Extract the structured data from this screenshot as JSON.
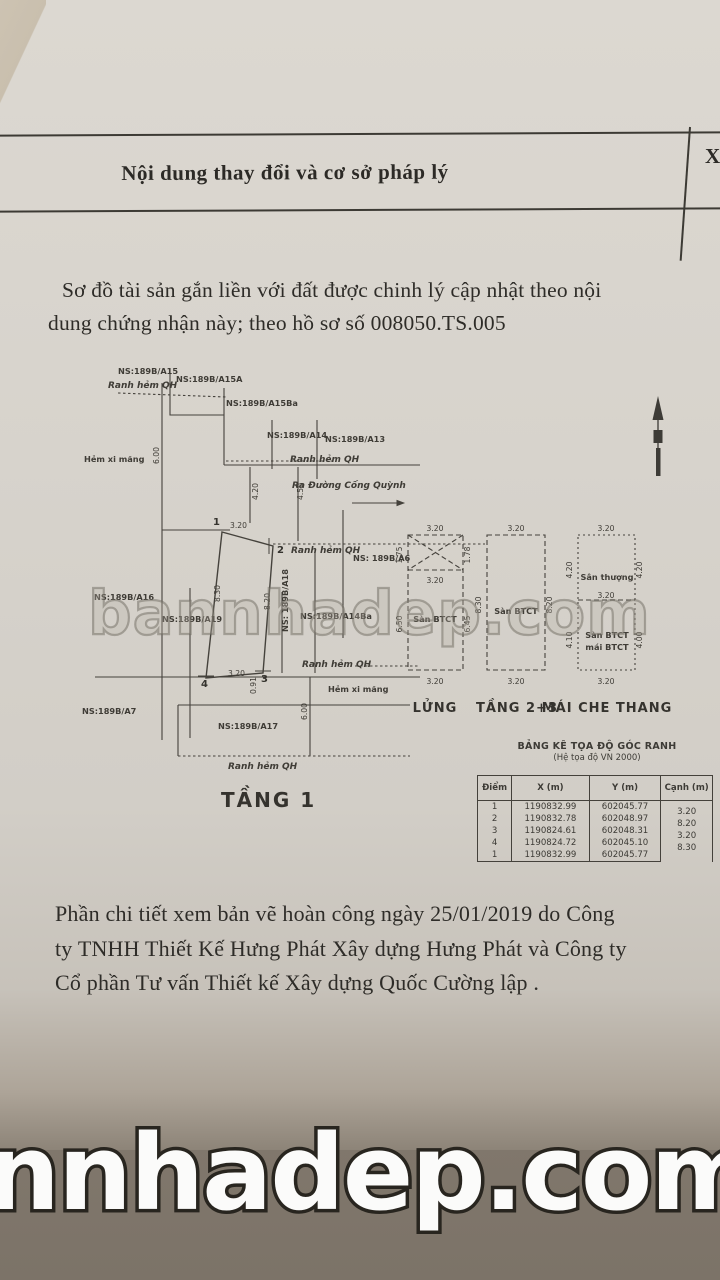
{
  "header": {
    "title": "Nội dung thay đổi và cơ sở pháp lý",
    "right_col_char": "X"
  },
  "intro": {
    "line1": "Sơ đồ tài sản gắn liền với đất được chinh lý cập nhật theo nội",
    "line2": "dung chứng nhận này;  theo hồ sơ số  008050.TS.005"
  },
  "site_plan": {
    "caption": "TẦNG 1",
    "streets": {
      "ranh_hem_qh": "Ranh hẻm QH",
      "hem_xi_mang": "Hẻm xi măng",
      "ra_duong_cong_quynh": "Ra Đường Cống Quỳnh"
    },
    "parcels": {
      "a15": "NS:189B/A15",
      "a15a": "NS:189B/A15A",
      "a15ba": "NS:189B/A15Ba",
      "a14": "NS:189B/A14",
      "a13": "NS:189B/A13",
      "a6": "NS: 189B/A6",
      "a16": "NS:189B/A16",
      "a19": "NS:189B/A19",
      "a18": "NS: 189B/A18",
      "a14ba": "NS:189B/A14Ba",
      "a7": "NS:189B/A7",
      "a17": "NS:189B/A17"
    },
    "points": {
      "p1": "1",
      "p2": "2",
      "p3": "3",
      "p4": "4"
    },
    "dims": {
      "frontage": "3.20",
      "left_side": "8.30",
      "right_side": "8.20",
      "back": "3.20",
      "hem_width": "6.00",
      "d420": "4.20",
      "d450": "4.50",
      "d091": "0.91",
      "a17_depth": "6.00"
    }
  },
  "floor_plans": {
    "captions": {
      "lung": "LỬNG",
      "tang23": "TẦNG 2+3",
      "mai": "MÁI CHE THANG"
    },
    "lung": {
      "top": "3.20",
      "cross_left": "1.75",
      "cross_right": "1.78",
      "cross_bottom": "3.20",
      "label": "Sàn BTCT",
      "left": "6.50",
      "right": "6.45",
      "bottom": "3.20"
    },
    "tang23": {
      "top": "3.20",
      "left": "8.30",
      "right": "8.20",
      "label": "Sàn BTCT",
      "bottom": "3.20"
    },
    "mai": {
      "top": "3.20",
      "upper_left": "4.20",
      "upper_right": "4.20",
      "upper_label": "Sân thượng",
      "mid": "3.20",
      "lower_label1": "Sàn BTCT",
      "lower_label2": "mái BTCT",
      "lower_left": "4.10",
      "lower_right": "4.00",
      "bottom": "3.20"
    }
  },
  "coord_table": {
    "title": "BẢNG KÊ TỌA ĐỘ GÓC RANH",
    "subtitle": "(Hệ tọa độ VN 2000)",
    "headers": [
      "Điểm",
      "X (m)",
      "Y (m)",
      "Cạnh (m)"
    ],
    "rows": [
      [
        "1",
        "1190832.99",
        "602045.77"
      ],
      [
        "2",
        "1190832.78",
        "602048.97"
      ],
      [
        "3",
        "1190824.61",
        "602048.31"
      ],
      [
        "4",
        "1190824.72",
        "602045.10"
      ],
      [
        "1",
        "1190832.99",
        "602045.77"
      ]
    ],
    "edges": [
      "3.20",
      "8.20",
      "3.20",
      "8.30"
    ]
  },
  "footnote": {
    "line1": "Phần chi tiết xem  bản vẽ hoàn công ngày 25/01/2019 do  Công",
    "line2": "ty TNHH Thiết Kế Hưng Phát Xây dựng Hưng Phát và Công ty",
    "line3": "Cổ phần Tư vấn Thiết kế Xây dựng Quốc Cường lập ."
  },
  "watermarks": {
    "middle": "bannhadep.com",
    "bottom": "nnhadep.com"
  }
}
